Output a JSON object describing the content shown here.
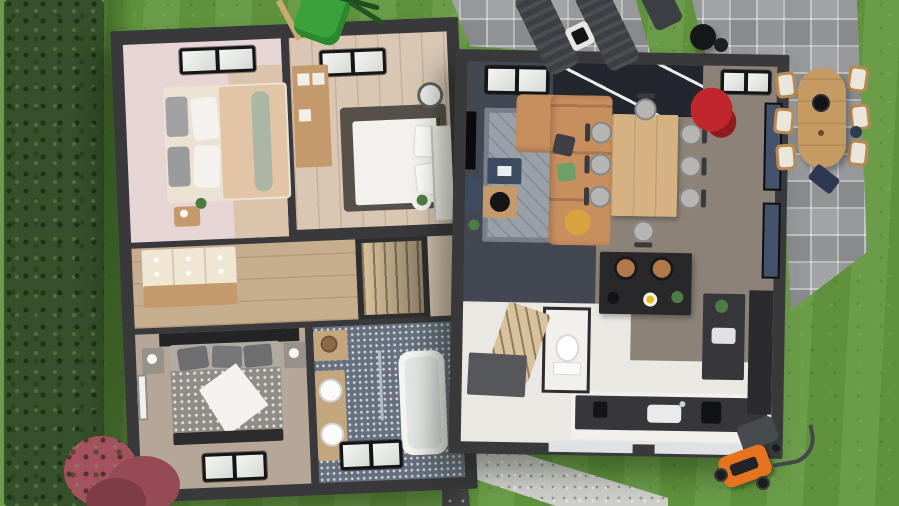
{
  "scene": {
    "type": "3d-floor-plan-render",
    "view": "top-down aerial",
    "subject": "Two-level house floor plan rendering with furnished rooms, surrounded by a garden with lawn, hedge, paver patio and outdoor furniture",
    "house": {
      "left_block_rooms": [
        {
          "name": "bedroom-pink",
          "features": [
            "skylight",
            "double bed with gray and white pillows",
            "sage throw",
            "wood nightstand",
            "plant",
            "cream dresser"
          ]
        },
        {
          "name": "bedroom-beige",
          "features": [
            "skylight",
            "wood shelving unit",
            "white double bed on dark rug",
            "round mirror",
            "white wardrobe",
            "plant table"
          ]
        },
        {
          "name": "hallway",
          "features": [
            "cream sideboard with knobs",
            "wood plank floor"
          ]
        },
        {
          "name": "staircase-upper",
          "features": [
            "wood treads"
          ]
        },
        {
          "name": "landing",
          "features": [
            "beige walls"
          ]
        },
        {
          "name": "bedroom-gray",
          "features": [
            "dark headboard wall",
            "patterned duvet bed with white blanket",
            "two nightstands with lamps",
            "wall art",
            "skylight"
          ]
        },
        {
          "name": "bathroom",
          "features": [
            "blue mosaic tile floor",
            "wood double-sink vanity",
            "bathtub",
            "glass screen",
            "towel",
            "skylight",
            "storage shelf with basket"
          ]
        }
      ],
      "right_block_rooms": [
        {
          "name": "living-room",
          "features": [
            "dark tile floor",
            "gray rug",
            "tan leather corner sofa",
            "dark pillow",
            "green pillow",
            "yellow throw",
            "navy side table",
            "wood coffee table with black tray",
            "wall TV",
            "media unit",
            "plant",
            "glass roof band",
            "two skylights"
          ]
        },
        {
          "name": "dining-area",
          "features": [
            "light wood dining table",
            "eight chairs with round gray seats"
          ]
        },
        {
          "name": "kitchen",
          "features": [
            "black island with two tan bar stools",
            "lemon plate",
            "plant",
            "kettle",
            "counter with sink and faucet",
            "coffee machine",
            "side counter with sink and plant",
            "tall dark cabinet",
            "window wall"
          ]
        },
        {
          "name": "entry",
          "features": [
            "white floor",
            "dark doormat",
            "lower staircase"
          ]
        },
        {
          "name": "wc",
          "features": [
            "toilet"
          ]
        }
      ]
    },
    "garden": {
      "elements": [
        "lawn",
        "tall hedge along left edge",
        "pink flower bush bottom-left",
        "red planter flowers at patio corner",
        "gray paver patio top-right",
        "two sun loungers",
        "white side table",
        "black barbecue grill",
        "oval teak dining table",
        "six teak chairs with white cushions",
        "folded navy chair",
        "orange lawn mower with grass bag",
        "green children slide",
        "gravel path along lower wall"
      ]
    }
  },
  "palette": {
    "grass": "#63973f",
    "hedge": "#35502a",
    "patio": "#a2a3a5",
    "gravel_light": "#cdcdc9",
    "gravel_dark": "#46484a",
    "wall": "#39383b",
    "bedroom_pink": "#e7d5d6",
    "bedroom_beige": "#d9c7b4",
    "hall_wood": "#c6ad8d",
    "landing": "#d3c1ae",
    "bedroom3_floor": "#b6a697",
    "bathroom_floor": "#67707f",
    "living_floor": "#434751",
    "dining_floor": "#8c8277",
    "kitchen_floor": "#eae8e3",
    "glass_roof": "#23272d",
    "rug": "#9aa0a7",
    "sofa": "#c78e5e",
    "island": "#28282b",
    "dining_table": "#d6b283",
    "outdoor_table": "#c69a63",
    "counter_top": "#37373b",
    "window_glass": "#45526b",
    "stairs_wood": "#d8c19d",
    "mower_orange": "#e6731f",
    "flower_bush": "#a3525e",
    "corner_flowers": "#c0262c",
    "slide_green": "#3aa23c",
    "lounger": "#3c4044",
    "doormat": "#56575b",
    "wood_furniture": "#c49a6c",
    "bed_linen": "#f2f1ed",
    "duvet_gray": "#8f8b85",
    "sage_throw": "#a9b7a4",
    "peach_duvet": "#e2c5a6",
    "navy_table": "#3d4b60",
    "green_pillow": "#6f9f67",
    "yellow_throw": "#d8a33e",
    "tub": "#f4f4f1",
    "vanity_wood": "#c3a57e",
    "stool_tan": "#b27a4b"
  }
}
